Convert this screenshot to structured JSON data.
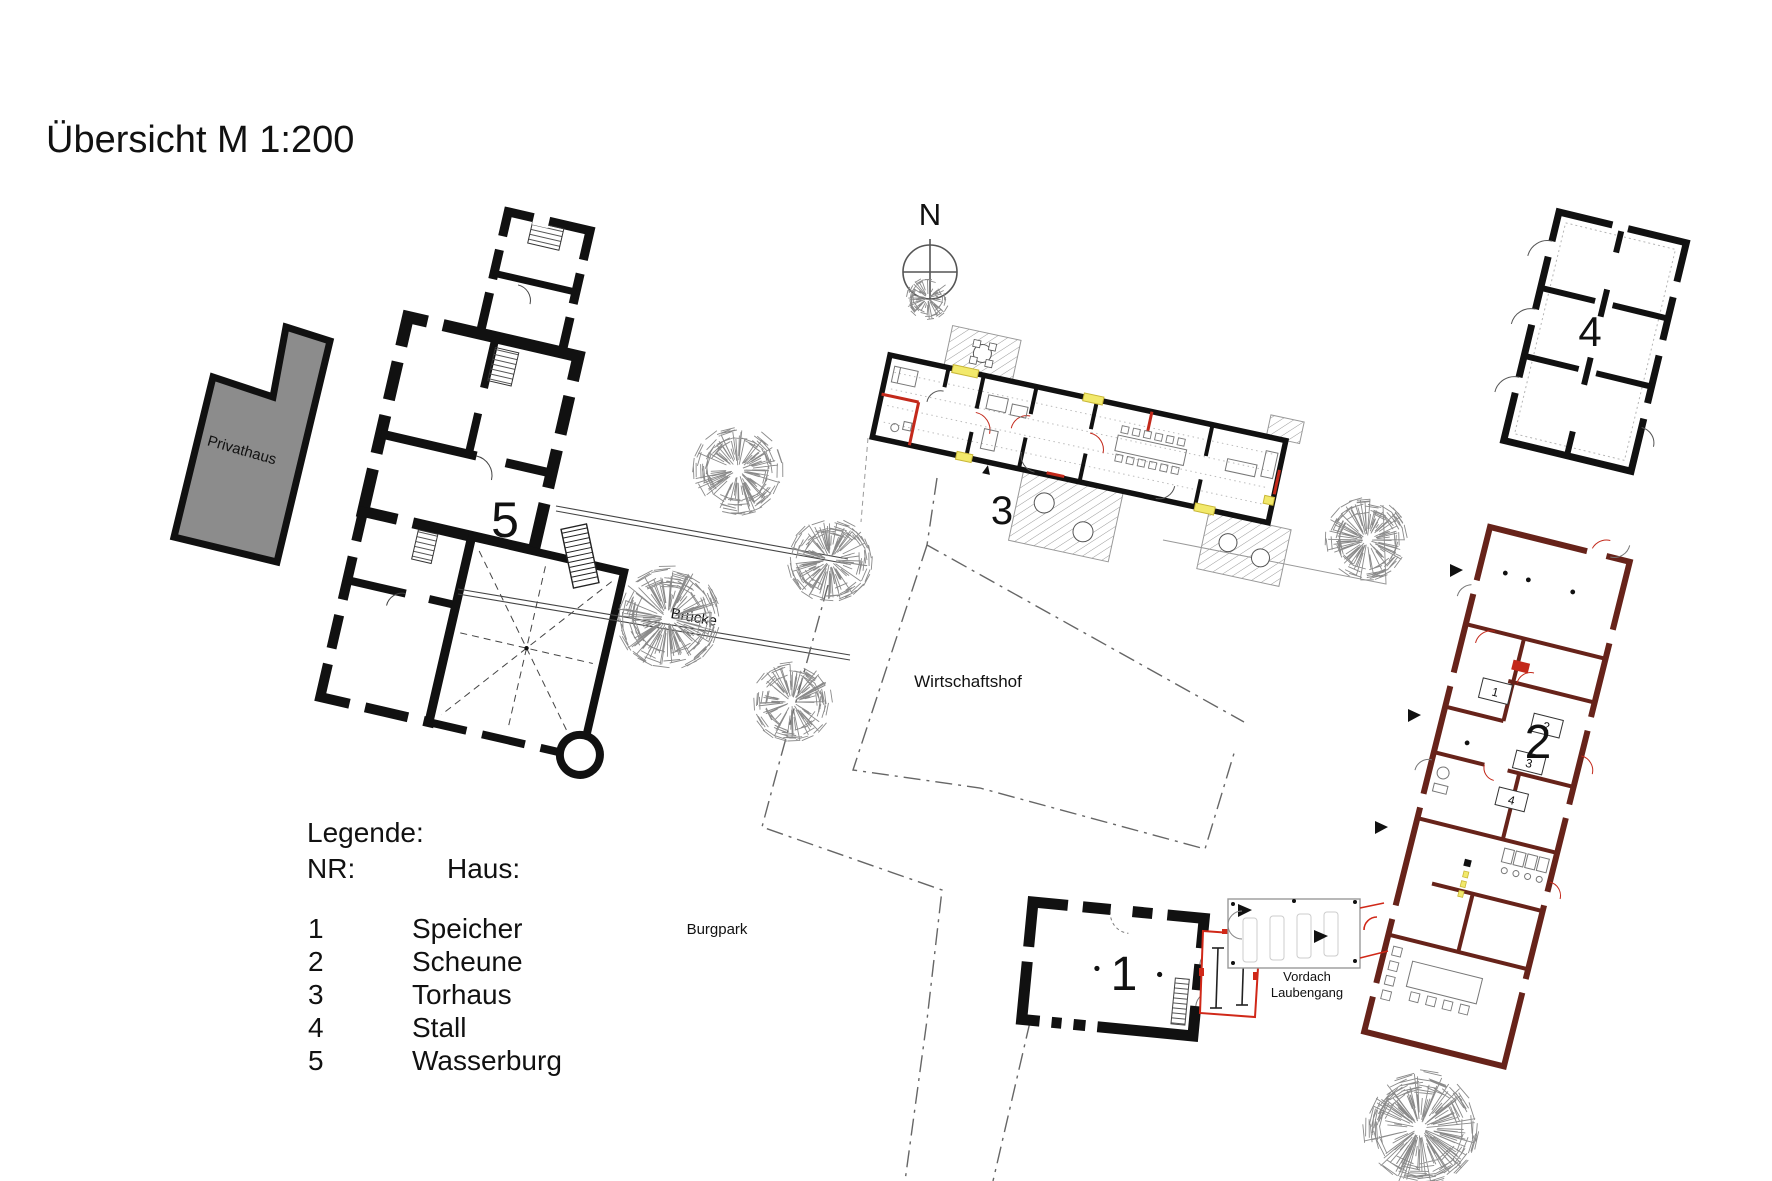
{
  "title": "Übersicht M 1:200",
  "north": {
    "label": "N"
  },
  "legend": {
    "heading": "Legende:",
    "col_nr": "NR:",
    "col_haus": "Haus:",
    "items": [
      {
        "nr": "1",
        "name": "Speicher",
        "color": "#111111"
      },
      {
        "nr": "2",
        "name": "Scheune",
        "color": "#111111"
      },
      {
        "nr": "3",
        "name": "Torhaus",
        "color": "#c3291b"
      },
      {
        "nr": "4",
        "name": "Stall",
        "color": "#111111"
      },
      {
        "nr": "5",
        "name": "Wasserburg",
        "color": "#111111"
      }
    ]
  },
  "site_labels": {
    "privathaus": "Privathaus",
    "bruecke": "Brücke",
    "wirtschaftshof": "Wirtschaftshof",
    "burgpark": "Burgpark",
    "vordach_line1": "Vordach",
    "vordach_line2": "Laubengang"
  },
  "plan": {
    "speicher_label": "1",
    "scheune_label": "2",
    "torhaus_label": "3",
    "stall_label": "4",
    "wasserburg_label": "5",
    "scheune_room_numbers": [
      "1",
      "2",
      "3",
      "4"
    ],
    "torhaus_label_color": "#c3291b"
  },
  "colors": {
    "accent_red": "#c3291b",
    "wall_maroon": "#67231a",
    "highlight_yellow": "#f2e96b",
    "building_gray": "#8c8c8c"
  }
}
